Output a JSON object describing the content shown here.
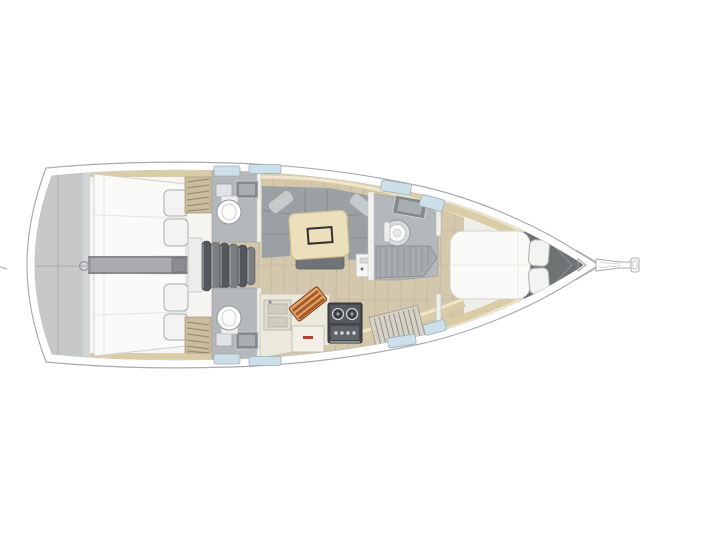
{
  "figure": {
    "kind": "sailboat-interior-deck-plan",
    "orientation": "bow-right",
    "visible_text": ""
  },
  "palette": {
    "background": "#ffffff",
    "hullFill": "#ffffff",
    "hullOutline": "#a7abaf",
    "interior": "#efeee9",
    "deckGray": "#c7c8ca",
    "deckSeam": "#a9aaac",
    "woodFloor": "#d3c7ac",
    "plankLine": "#bfb099",
    "shelfTan": "#d9cca7",
    "shelfHighlight": "#f0e7cb",
    "cabinWall": "#f6f5f1",
    "bedWhite": "#fafaf8",
    "bedOutline": "#d2d2d0",
    "pillowFill": "#f3f3f1",
    "pillowOutline": "#a8acae",
    "lockerSlat": "#c9bd9e",
    "corridorGray": "#939598",
    "stepsDark": "#54585c",
    "stepsLight": "#7b7f83",
    "stepsFrame": "#ececea",
    "bathFloor": "#b5b8ba",
    "fixtureDark": "#82888c",
    "fixtureLight": "#a9aeb1",
    "toiletWhite": "#ffffff",
    "toiletRing": "#94989b",
    "sofaGray": "#9aa0a3",
    "sofaPillow": "#c7cacb",
    "tableWood": "#ebdfbc",
    "tableEdge": "#cdbb8e",
    "tableMark": "#2f3133",
    "benchGray": "#707478",
    "cabinetWhite": "#f4f4f2",
    "counterCream": "#ebe8dc",
    "counterEdge": "#c6c2b2",
    "boardLight": "#e2a870",
    "boardDark": "#a85a28",
    "stoveDark": "#45494d",
    "stovePanel": "#606468",
    "grateGray": "#a7abae",
    "grateLine": "#8d9194",
    "bowLocker": "#6e7275",
    "windowBlue": "#cddfe8",
    "windowBorder": "#9ab0bc",
    "slatFill": "#d6d2c6",
    "slatLine": "#8f8d84"
  }
}
